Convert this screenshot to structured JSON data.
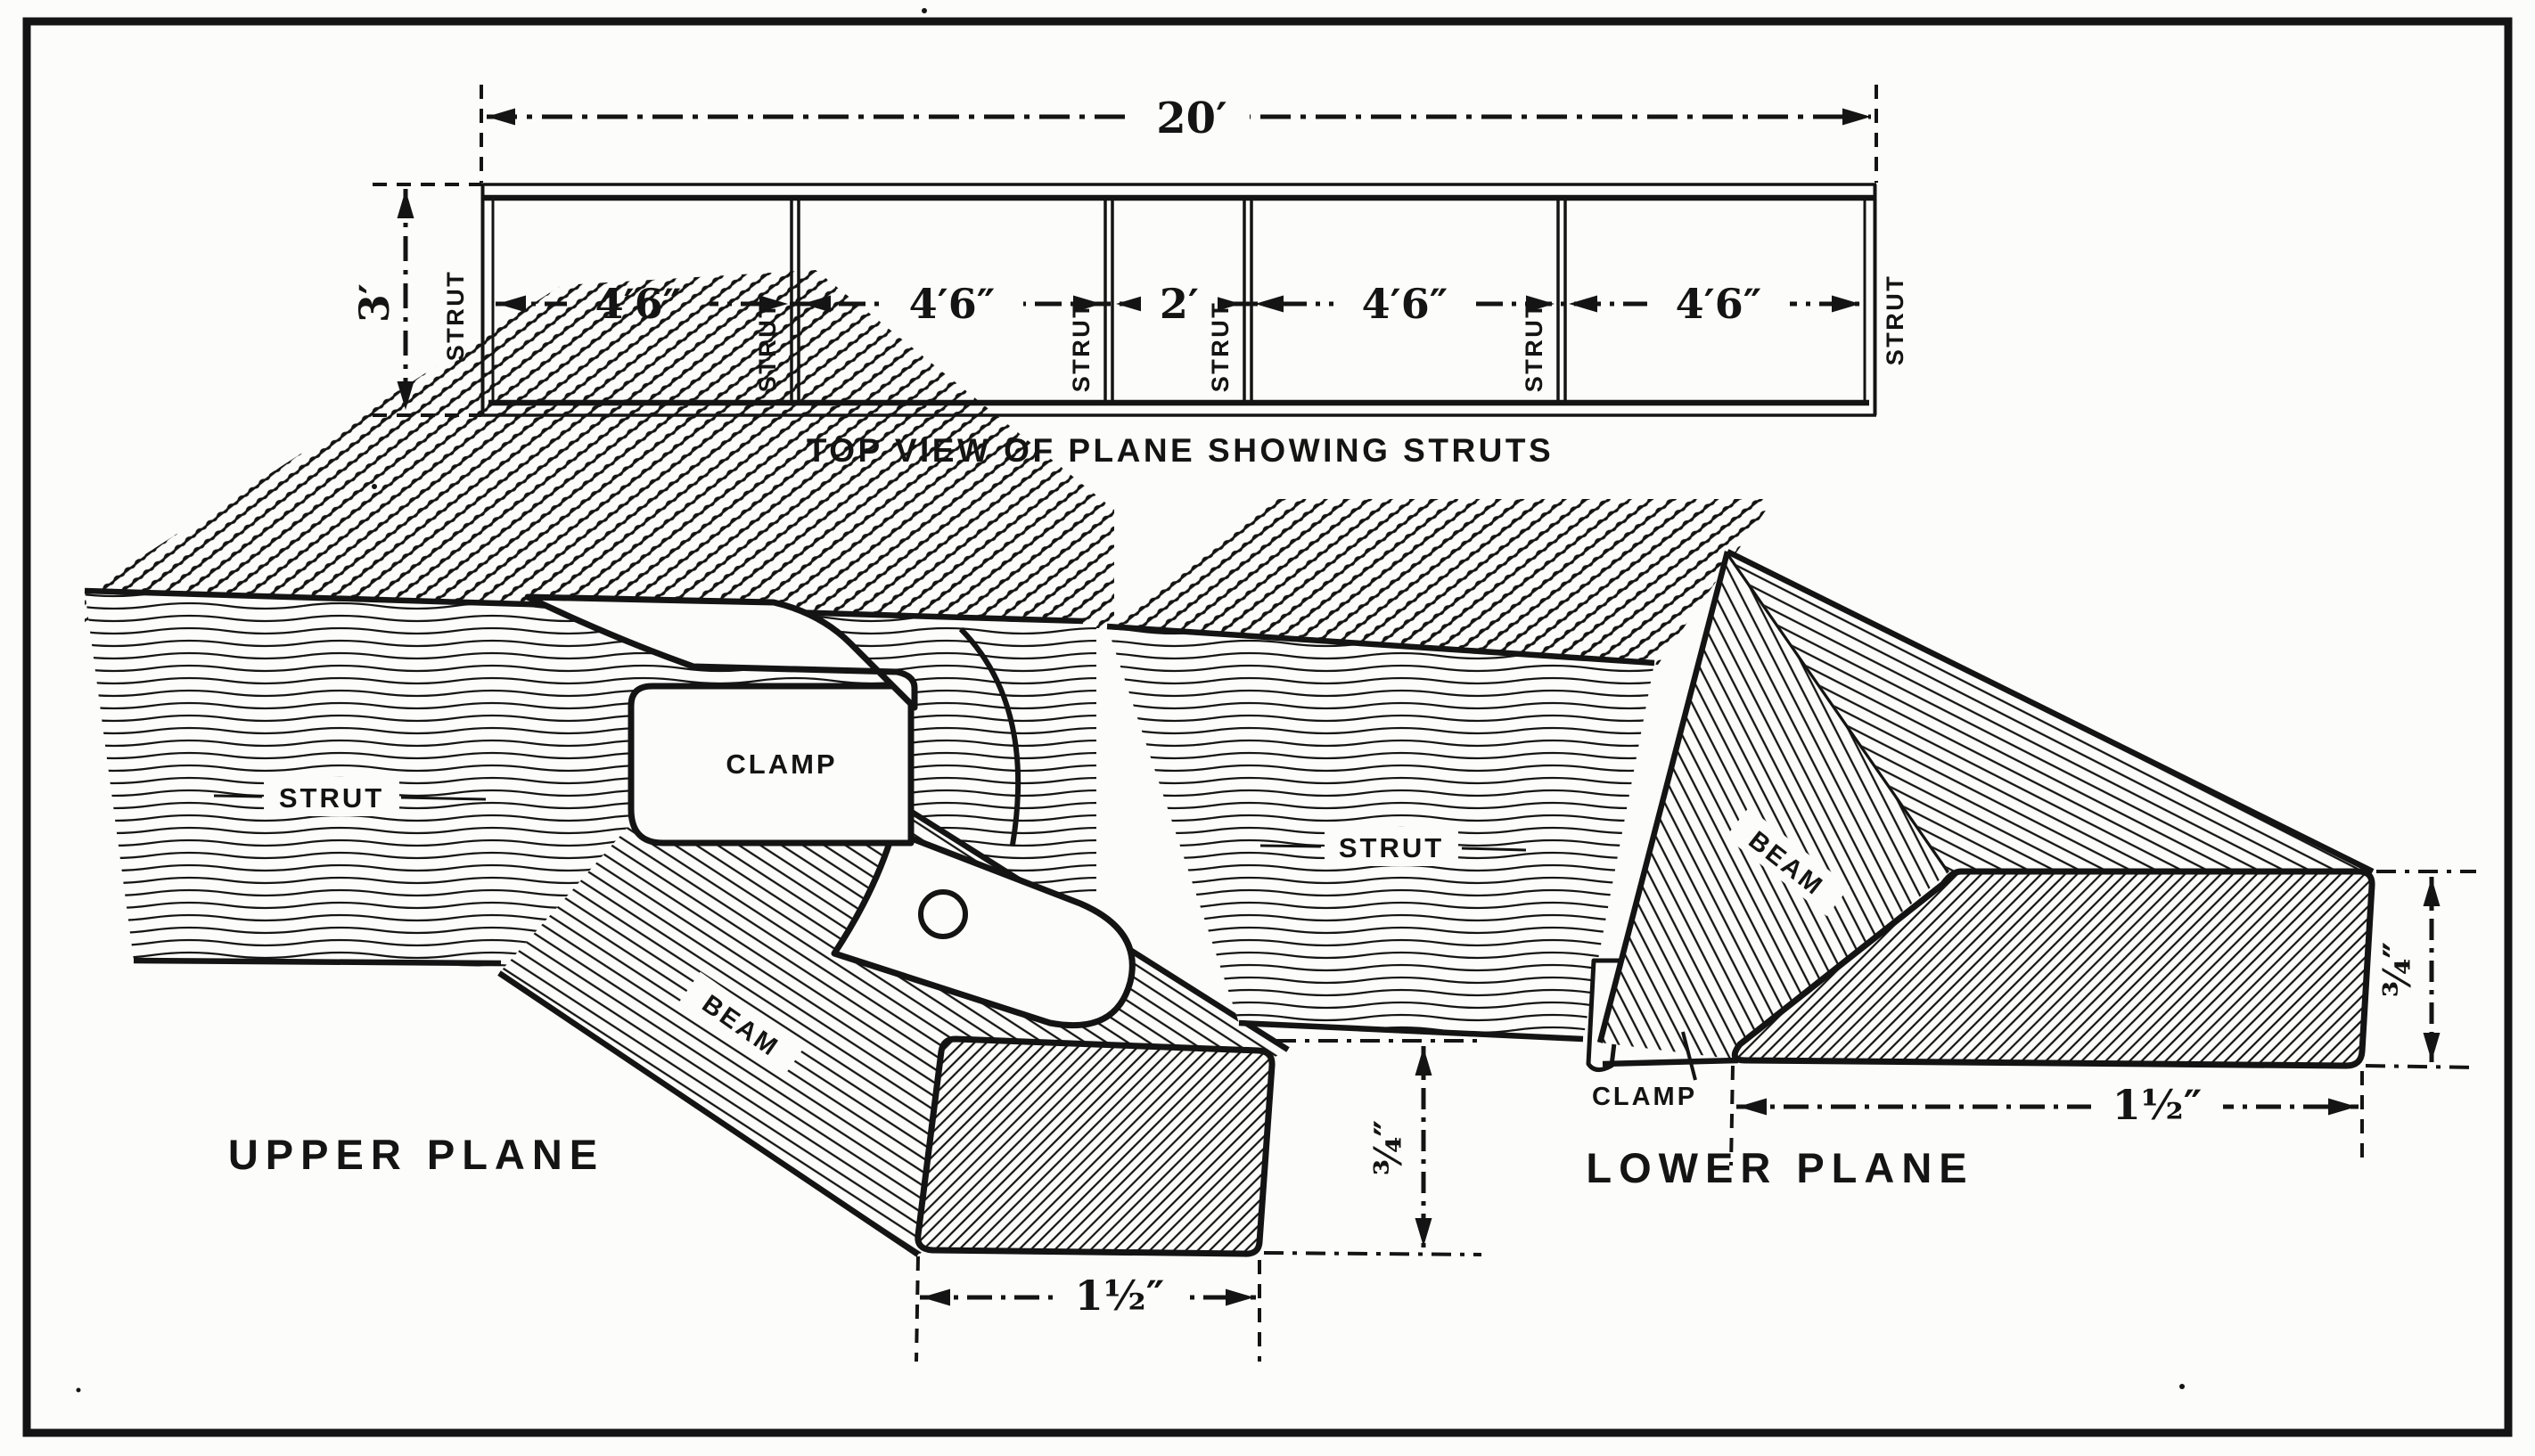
{
  "figure": {
    "colors": {
      "ink": "#141414",
      "paper": "#fcfcfa"
    },
    "top_view": {
      "caption": "TOP VIEW OF PLANE SHOWING STRUTS",
      "length_label": "20′",
      "height_label": "3′",
      "bay_labels": [
        "4′6″",
        "4′6″",
        "2′",
        "4′6″",
        "4′6″"
      ],
      "strut_labels": [
        "STRUT",
        "STRUT",
        "STRUT",
        "STRUT",
        "STRUT",
        "STRUT"
      ]
    },
    "upper_detail": {
      "caption": "UPPER PLANE",
      "strut_label": "STRUT",
      "clamp_label": "CLAMP",
      "beam_label": "BEAM",
      "width_label": "1½″",
      "thickness_label": "¾″"
    },
    "lower_detail": {
      "caption": "LOWER PLANE",
      "strut_label": "STRUT",
      "clamp_label": "CLAMP",
      "beam_label": "BEAM",
      "width_label": "1½″",
      "thickness_label": "¾″"
    }
  }
}
